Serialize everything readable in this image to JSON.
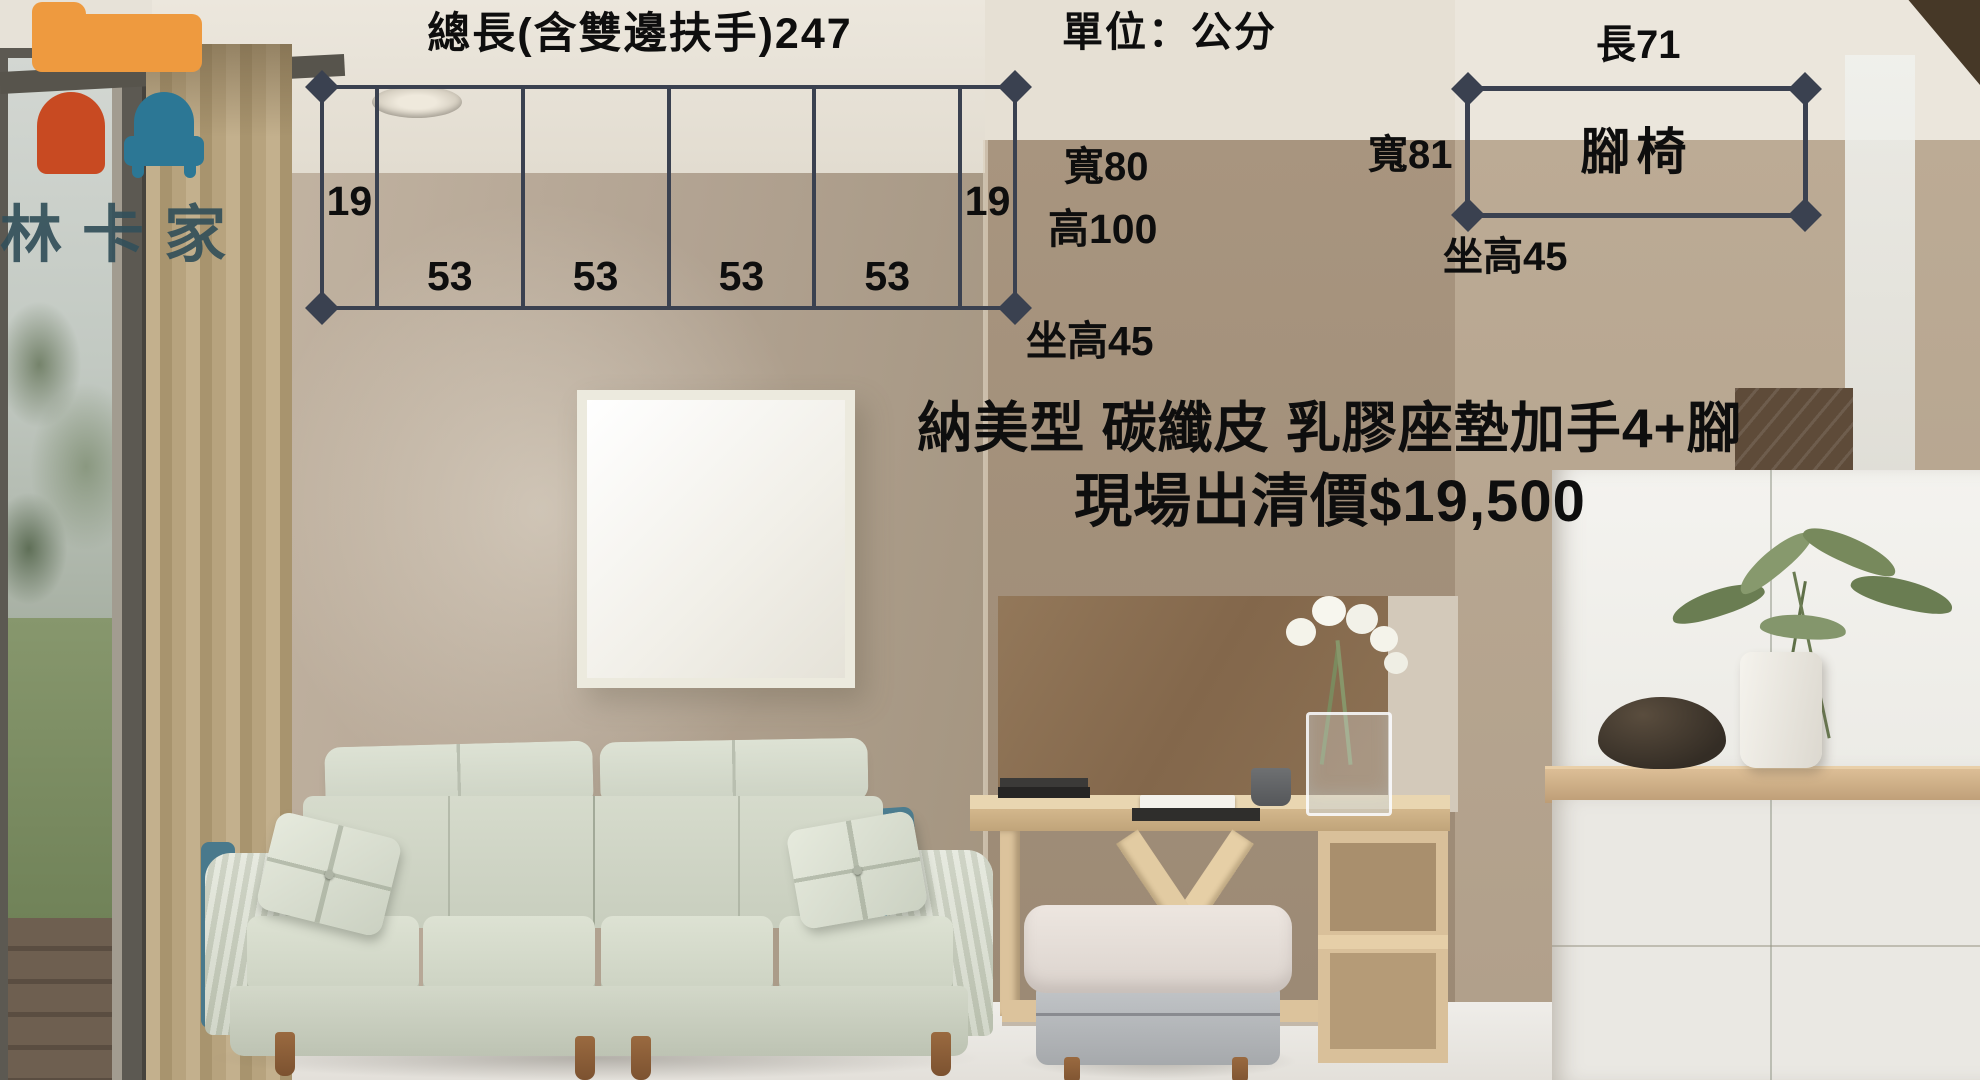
{
  "theme": {
    "diagram_line": "#3a4150",
    "text_dark": "#0e0e0e",
    "logo_orange": "#ee9a3f",
    "logo_red": "#c84a22",
    "logo_teal": "#2c7795",
    "watermark": "#33505a"
  },
  "brand": {
    "watermark": "林卡家"
  },
  "unit_note": "單位：公分",
  "sofa_diagram": {
    "title": "總長(含雙邊扶手)247",
    "total_length_cm": 247,
    "segments": [
      19,
      53,
      53,
      53,
      53,
      19
    ],
    "width": "寬80",
    "height": "高100",
    "seat_height": "坐高45"
  },
  "footstool_diagram": {
    "label": "腳椅",
    "length": "長71",
    "width": "寬81",
    "seat_height": "坐高45"
  },
  "product": {
    "title": "納美型 碳纖皮 乳膠座墊加手4+腳",
    "price": "現場出清價$19,500"
  }
}
